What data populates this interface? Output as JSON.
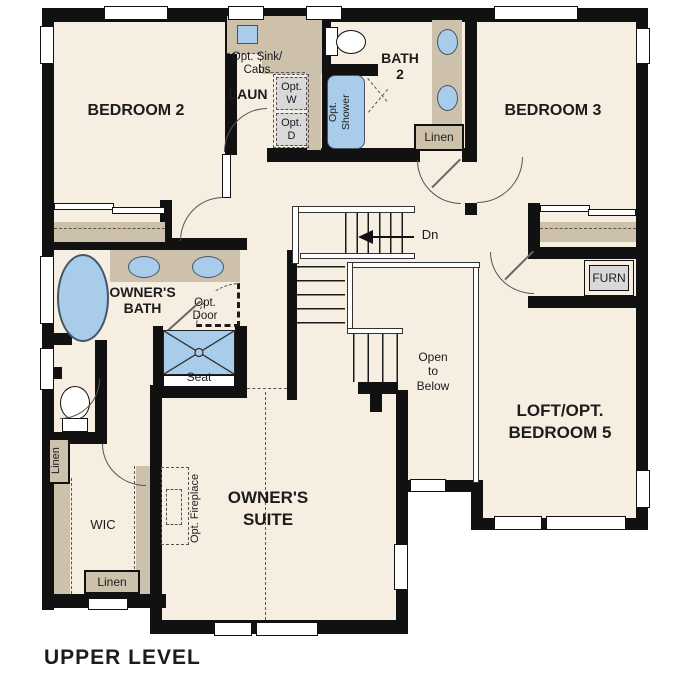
{
  "title": "UPPER LEVEL",
  "colors": {
    "floor": "#f6eee1",
    "wall": "#111111",
    "cabinet": "#cdc1ab",
    "fixture_blue": "#a8cce9",
    "appliance_gray": "#d9d9d9"
  },
  "rooms": {
    "bedroom2": {
      "label": "BEDROOM 2"
    },
    "bedroom3": {
      "label": "BEDROOM 3"
    },
    "bath2": {
      "line1": "BATH",
      "line2": "2",
      "shower_line1": "Opt.",
      "shower_line2": "Shower",
      "linen": "Linen"
    },
    "laundry": {
      "label": "LAUN",
      "sink_line1": "Opt. Sink/",
      "sink_line2": "Cabs",
      "washer_line1": "Opt.",
      "washer_line2": "W",
      "dryer_line1": "Opt.",
      "dryer_line2": "D"
    },
    "furnace": {
      "label": "FURN"
    },
    "loft": {
      "line1": "LOFT/OPT.",
      "line2": "BEDROOM 5"
    },
    "stairs": {
      "down": "Dn"
    },
    "open_to_below": {
      "line1": "Open",
      "line2": "to",
      "line3": "Below"
    },
    "owners_bath": {
      "line1": "OWNER'S",
      "line2": "BATH",
      "opt_door_line1": "Opt.",
      "opt_door_line2": "Door",
      "seat": "Seat"
    },
    "owners_suite": {
      "line1": "OWNER'S",
      "line2": "SUITE",
      "fireplace": "Opt. Fireplace"
    },
    "wic": {
      "label": "WIC",
      "linen_side": "Linen",
      "linen_bottom": "Linen"
    }
  }
}
